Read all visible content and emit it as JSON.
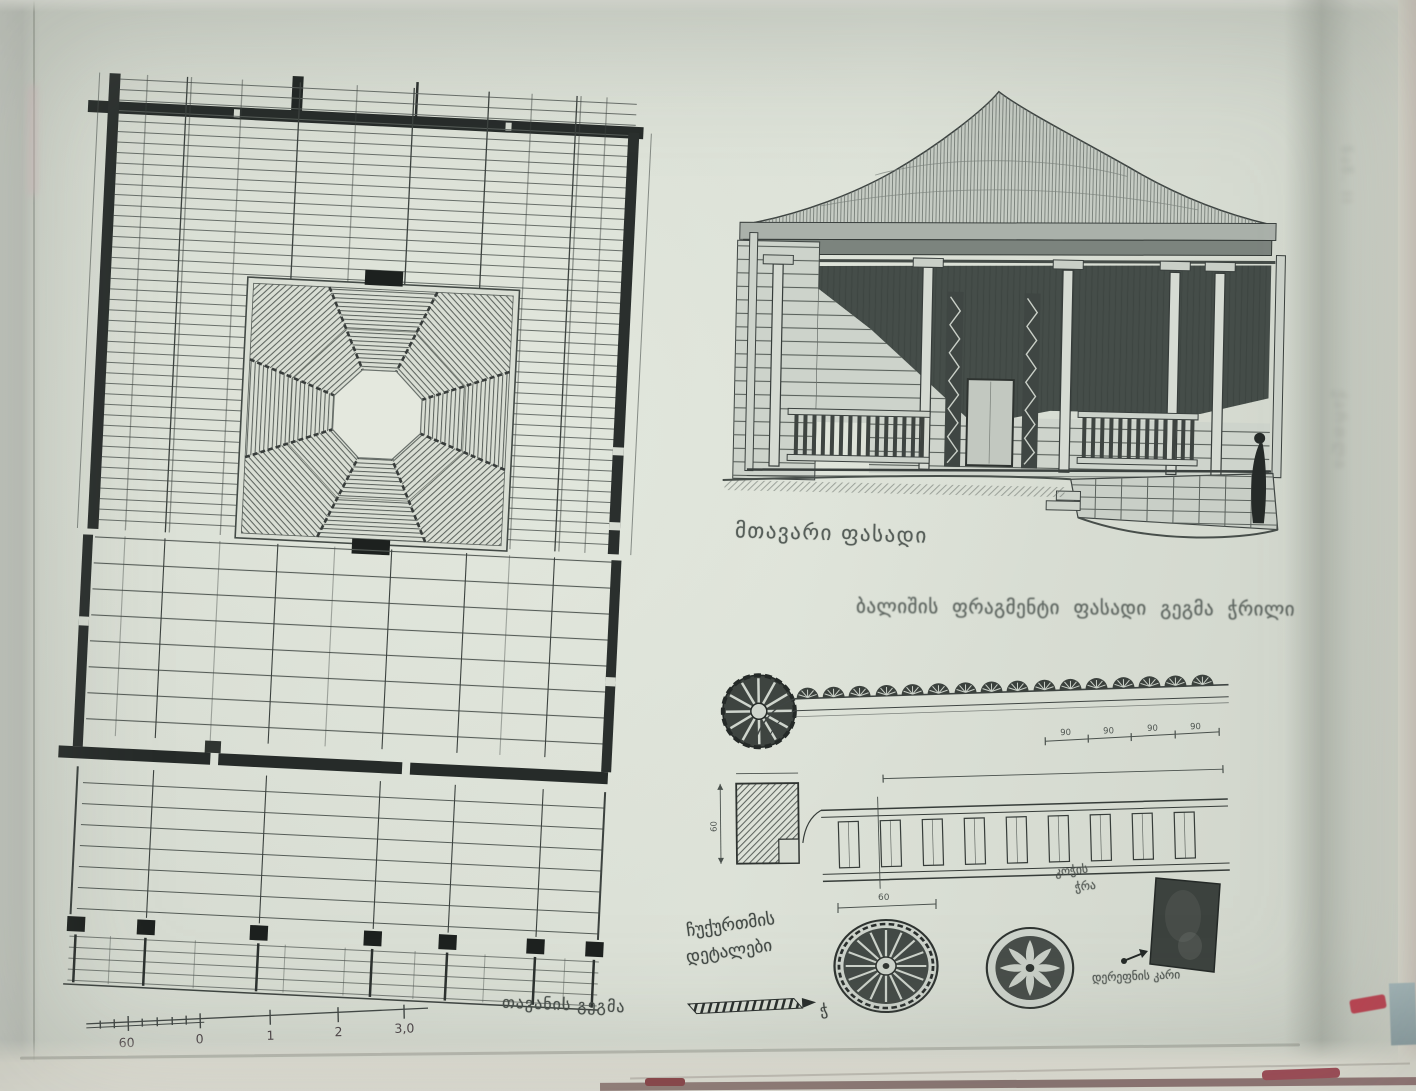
{
  "photo": {
    "type": "photograph of a book page with architectural drawings",
    "page_color": "#d7dcd2",
    "ink_color": "#3a403d"
  },
  "captions": {
    "ceiling_plan": "თავანის გეგმა",
    "main_facade": "მთავარი ფასადი",
    "fragment_caption": "ბალიშის ფრაგმენტი ფასადი გეგმა ჭრილი",
    "ornament_details_line1": "ჩუქურთმის",
    "ornament_details_line2": "დეტალები",
    "panel_label_top_line1": "კოჭის",
    "panel_label_top_line2": "ჭრა",
    "panel_label_bottom": "დერეფნის კარი",
    "hatch_mark_glyph": "ჭ",
    "margin_note_top": "ნაწ. II",
    "margin_note_bottom": "ქართლი"
  },
  "scale_bar": {
    "labels": [
      "60",
      "0",
      "1",
      "2",
      "3,0"
    ]
  },
  "dimensions": {
    "frieze_segments": [
      "90",
      "90",
      "90",
      "90"
    ],
    "detail_square_height": "60",
    "rosette_width": "60"
  }
}
